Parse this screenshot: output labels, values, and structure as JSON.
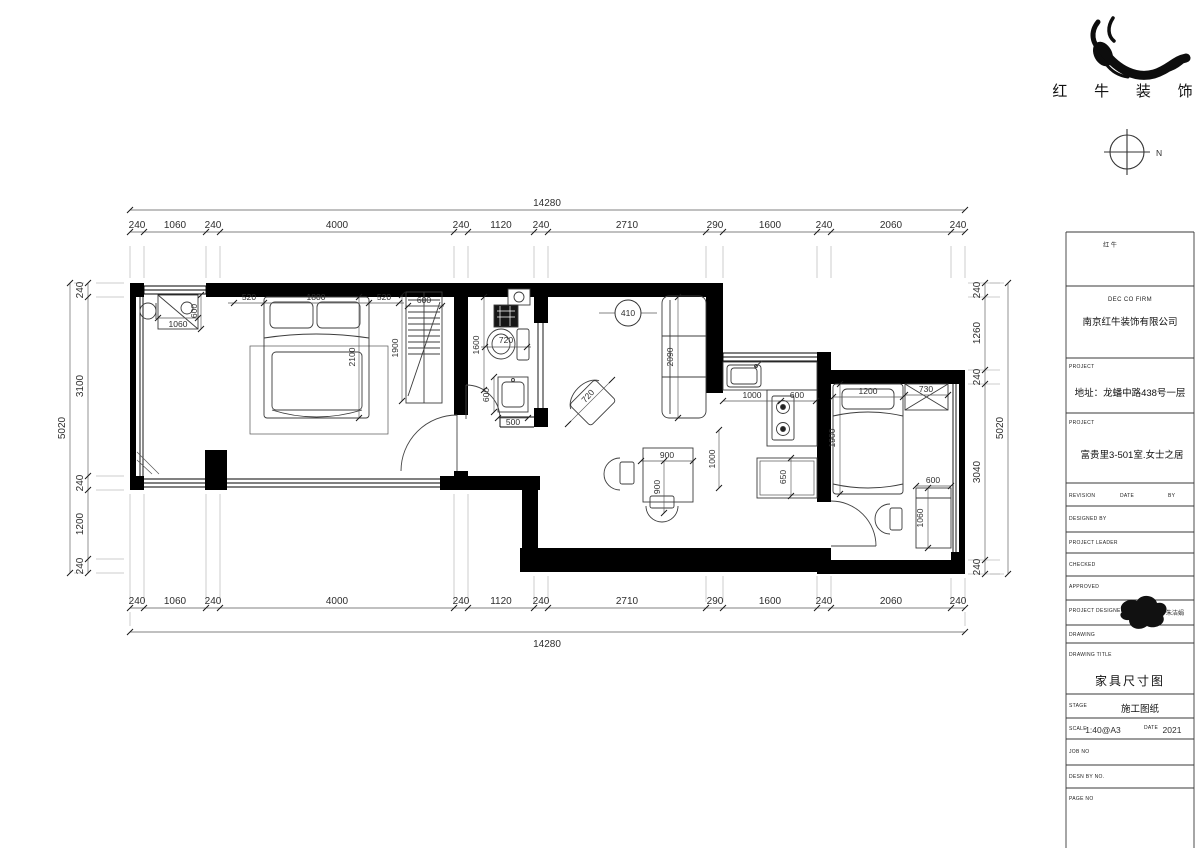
{
  "logo": {
    "company": "红 牛 装 饰",
    "mark": "红 牛"
  },
  "north": {
    "label": "N"
  },
  "plan": {
    "top_total": "14280",
    "bottom_total": "14280",
    "left_total": "5020",
    "right_total": "5020",
    "top": [
      "240",
      "1060",
      "240",
      "4000",
      "240",
      "1120",
      "240",
      "2710",
      "290",
      "1600",
      "240",
      "2060",
      "240"
    ],
    "bottom": [
      "240",
      "1060",
      "240",
      "4000",
      "240",
      "1120",
      "240",
      "2710",
      "290",
      "1600",
      "240",
      "2060",
      "240"
    ],
    "left": [
      "240",
      "3100",
      "240",
      "1200",
      "240"
    ],
    "right": [
      "240",
      "1260",
      "240",
      "3040",
      "240"
    ],
    "room1": {
      "bed_side_l": "520",
      "bed_w": "1800",
      "bed_side_r": "520",
      "bed_len": "2100",
      "desk_w": "1060",
      "desk_d": "600",
      "ward_w": "600",
      "ward_len": "1900"
    },
    "bath": {
      "toilet_w": "720",
      "len": "1600",
      "sink_d": "600",
      "sink_w": "500"
    },
    "living": {
      "bubble": "410",
      "sofa_len": "2090",
      "chair_w": "720",
      "table_w": "900",
      "table_d": "900",
      "clear": "1000"
    },
    "kitchen": {
      "sink_w": "1000",
      "stove_w": "600",
      "cab_d": "650"
    },
    "room2": {
      "bed_w": "1200",
      "bed_len": "1900",
      "ward_w": "730",
      "desk_w": "600",
      "desk_len": "1060"
    }
  },
  "tb": {
    "firm_label": "DEC CO FIRM",
    "company": "南京红牛装饰有限公司",
    "project_label": "PROJECT",
    "address": "地址：龙蟠中路438号一层",
    "project_label2": "PROJECT",
    "project_name": "富贵里3-501室.女士之居",
    "revision": "REVISION",
    "date": "DATE",
    "by": "BY",
    "designed_by": "DESIGNED BY",
    "project_leader": "PROJECT LEADER",
    "checked": "CHECKED",
    "approved": "APPROVED",
    "project_designer": "PROJECT DESIGNER",
    "signature": "朱洁娟",
    "drawing": "DRAWING",
    "drawing_title_label": "DRAWING TITLE",
    "drawing_title": "家具尺寸图",
    "stage_label": "STAGE",
    "stage": "施工图纸",
    "scale_label": "SCALE",
    "scale": "1:40@A3",
    "date_label": "DATE",
    "date_value": "2021",
    "job_no": "JOB NO",
    "desn_by_no": "DESN BY NO.",
    "page_no": "PAGE NO"
  }
}
